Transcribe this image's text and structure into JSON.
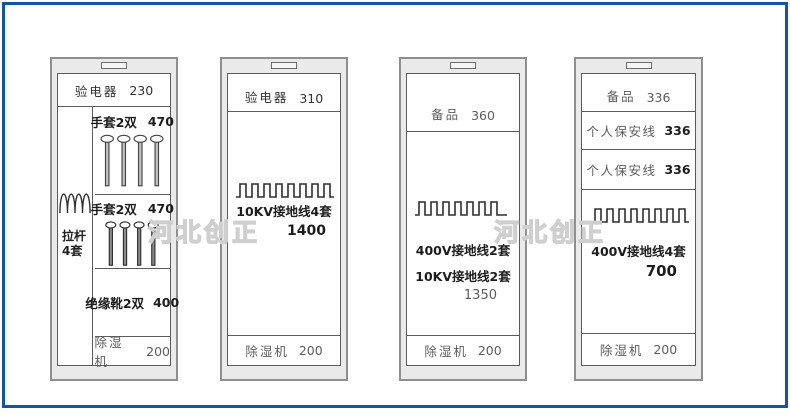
{
  "watermarks": {
    "left": "河北创正",
    "right": "河北创正"
  },
  "cabinets": [
    {
      "id": "cabinet-1",
      "header": {
        "label": "验电器",
        "value": "230"
      },
      "left_column": {
        "line1": "拉杆",
        "line2": "4套"
      },
      "gloves1": {
        "label": "手套2双",
        "value": "470"
      },
      "gloves2": {
        "label": "手套2双",
        "value": "470"
      },
      "boots": {
        "label": "绝缘靴2双",
        "value": "400"
      },
      "dehumidifier": {
        "label": "除湿机",
        "value": "200"
      }
    },
    {
      "id": "cabinet-2",
      "header": {
        "label": "验电器",
        "value": "310"
      },
      "main": {
        "line1": "10KV接地线4套",
        "line2": "1400"
      },
      "dehumidifier": {
        "label": "除湿机",
        "value": "200"
      }
    },
    {
      "id": "cabinet-3",
      "header": {
        "label": "备品",
        "value": "360"
      },
      "main": {
        "line1": "400V接地线2套",
        "line2": "10KV接地线2套",
        "line3": "1350"
      },
      "dehumidifier": {
        "label": "除湿机",
        "value": "200"
      }
    },
    {
      "id": "cabinet-4",
      "header": {
        "label": "备品",
        "value": "336"
      },
      "shelf1": {
        "label": "个人保安线",
        "value": "336"
      },
      "shelf2": {
        "label": "个人保安线",
        "value": "336"
      },
      "main": {
        "line1": "400V接地线4套",
        "line2": "700"
      },
      "dehumidifier": {
        "label": "除湿机",
        "value": "200"
      }
    }
  ],
  "colors": {
    "frame_blue": "#0f57a5",
    "cabinet_fill": "#eaeaea",
    "line_gray": "#5c5c5c",
    "watermark_gray": "#cfcfcf"
  }
}
